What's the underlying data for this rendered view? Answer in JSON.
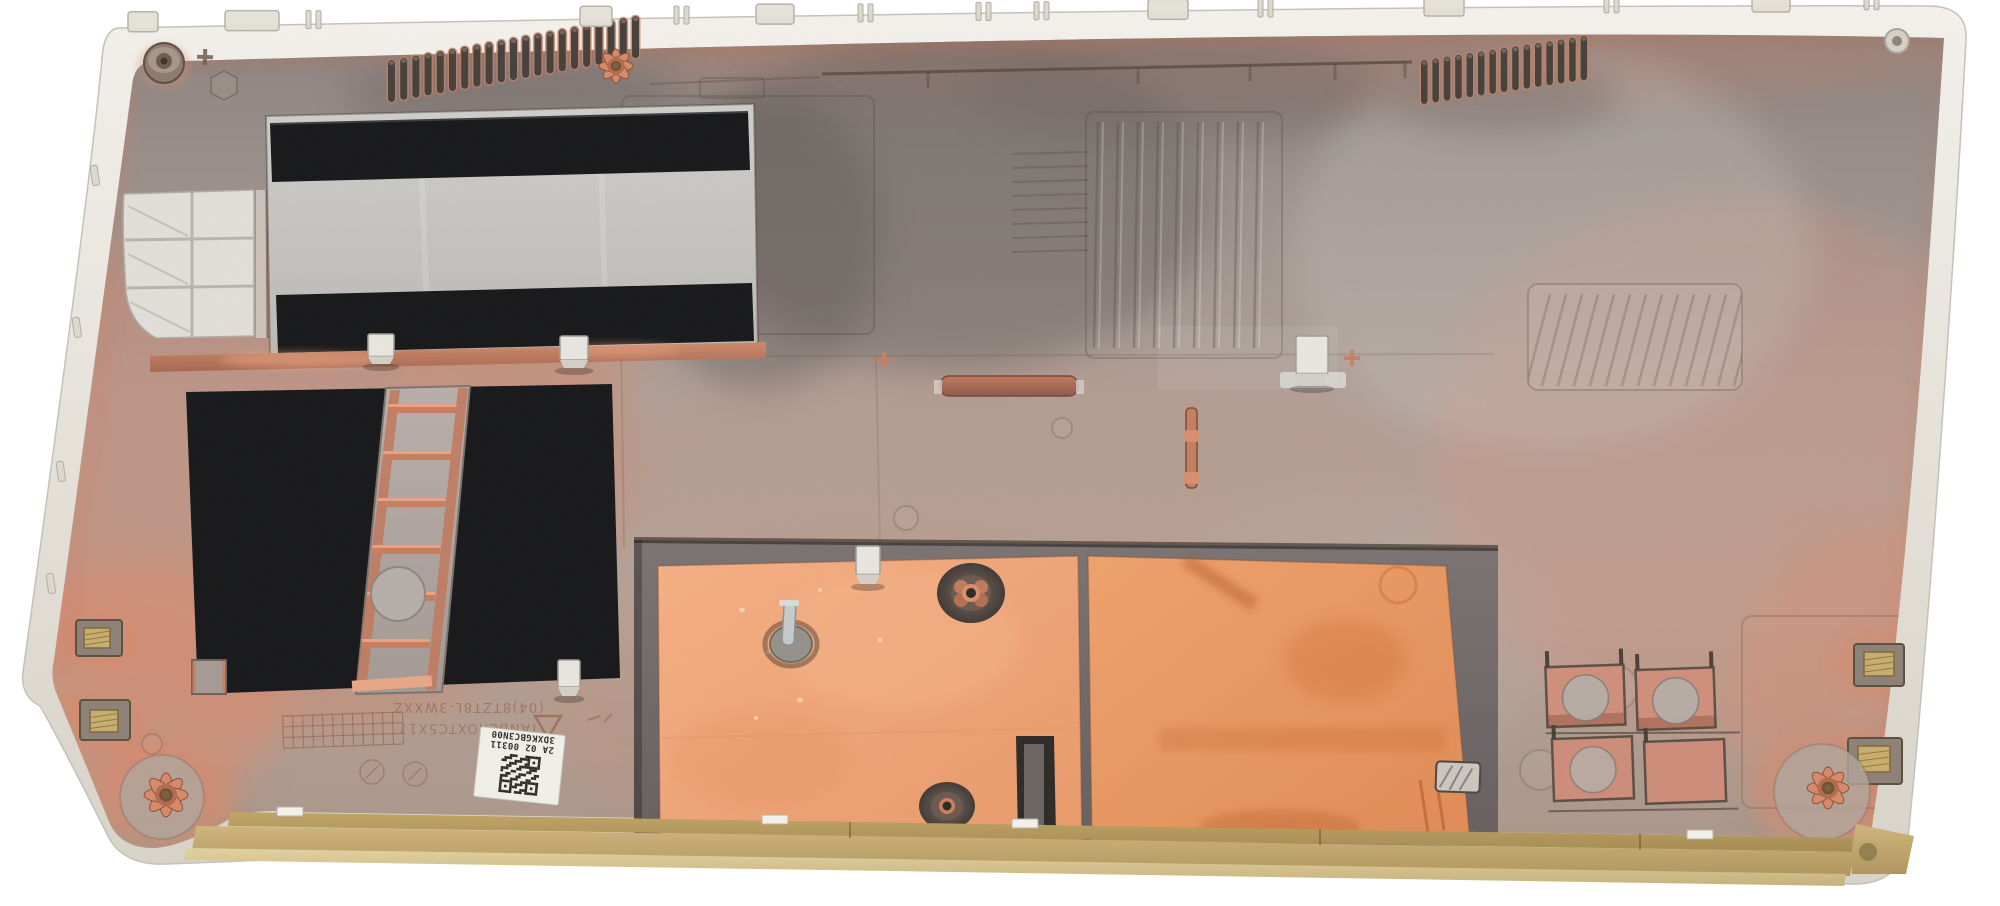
{
  "scene": {
    "alt": "Interior view of a silver laptop bottom case with copper-tinted EMI coating, black insulating tape panels, copper shielding foil, cooling vent slots and a gold-anodized bottom edge",
    "background": "#ffffff"
  },
  "labels": {
    "service_sticker": {
      "line1": "3DXKGBC3N00",
      "line2": "2A 02 00311"
    },
    "mold_text": {
      "line1": "(04)8TZT8L-3WXXZ",
      "line2": "TANBEROXTC5X17"
    }
  },
  "counts": {
    "left_vent_slots": 21,
    "right_vent_slots": 15,
    "ladder_rungs": 6,
    "qr_modules": 15
  },
  "colors": {
    "rim": "#e9e6df",
    "metal_base": "#a99a93",
    "copper_glow": "#c58064",
    "copper_bright": "#eda183",
    "black_tape": "#16171a",
    "panel_gray": "#c9c8c4",
    "foil_light": "#f2a87c",
    "foil_deep": "#e8995f",
    "stain": "#bf6227",
    "gold_edge": "#c9ae6d",
    "ladder_gray": "#b2a8a3",
    "grommet_dark": "#4a443f",
    "sticker_white": "#f2f1ec",
    "qr_dark": "#2b2a27",
    "etch_copper": "#9b6a52"
  }
}
